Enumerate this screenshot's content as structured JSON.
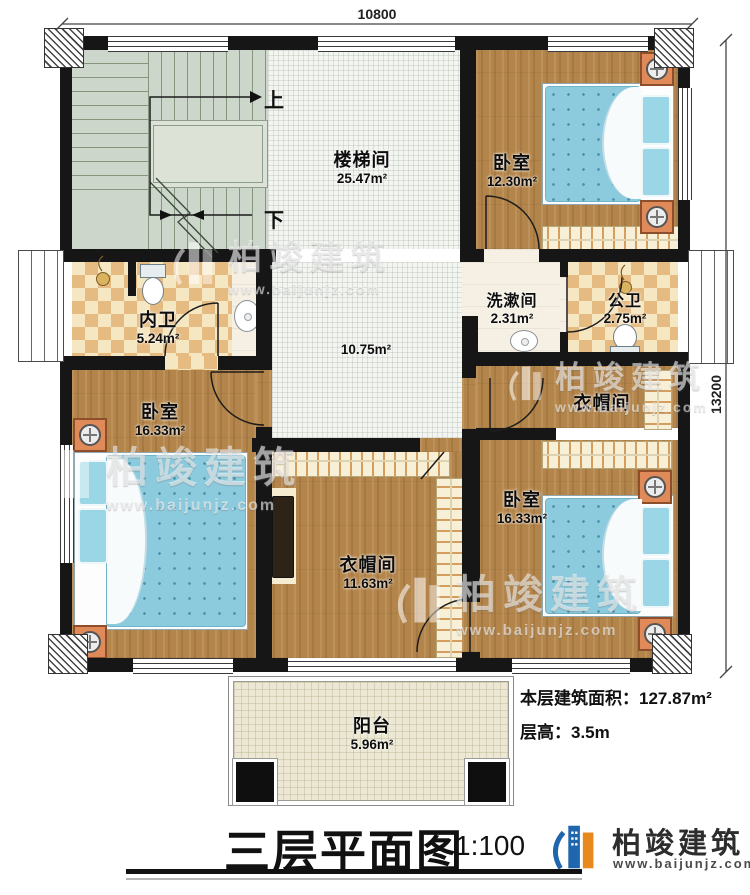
{
  "dimensions": {
    "top": "10800",
    "right": "13200"
  },
  "stairs": {
    "up": "上",
    "down": "下"
  },
  "rooms": {
    "stairwell": {
      "name": "楼梯间",
      "area": "25.47m²"
    },
    "hall": {
      "area": "10.75m²"
    },
    "bedroom_top_right": {
      "name": "卧室",
      "area": "12.30m²"
    },
    "inner_bath": {
      "name": "内卫",
      "area": "5.24m²"
    },
    "washroom": {
      "name": "洗漱间",
      "area": "2.31m²"
    },
    "public_bath": {
      "name": "公卫",
      "area": "2.75m²"
    },
    "bedroom_left": {
      "name": "卧室",
      "area": "16.33m²"
    },
    "cloakroom_center": {
      "name": "衣帽间",
      "area": "11.63m²"
    },
    "cloakroom_right": {
      "name": "衣帽间"
    },
    "bedroom_bottom_right": {
      "name": "卧室",
      "area": "16.33m²"
    },
    "balcony": {
      "name": "阳台",
      "area": "5.96m²"
    }
  },
  "info": {
    "area_label": "本层建筑面积：",
    "area_value": "127.87m²",
    "height_label": "层高：",
    "height_value": "3.5m"
  },
  "title": {
    "text": "三层平面图",
    "scale": "1:100"
  },
  "brand": {
    "name": "柏竣建筑",
    "url": "www.baijunjz.com"
  },
  "watermark": {
    "name": "柏竣建筑",
    "url": "www.baijunjz.com"
  }
}
